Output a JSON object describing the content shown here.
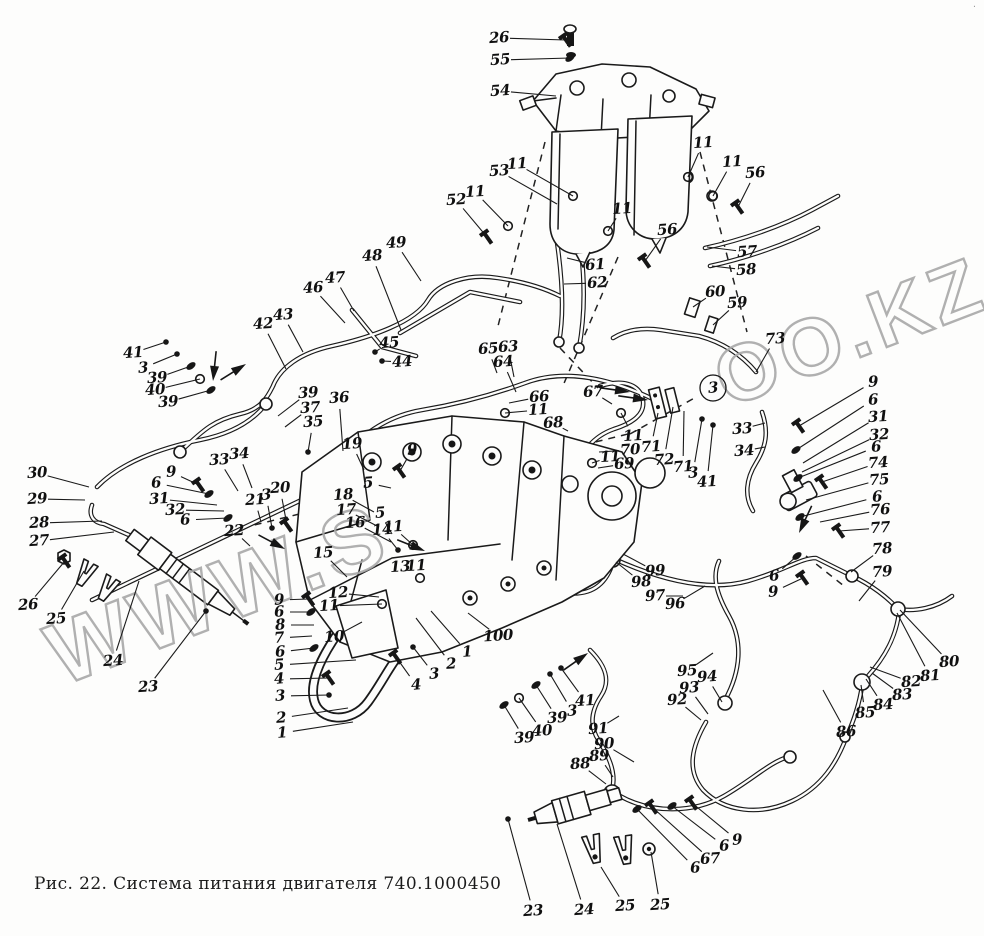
{
  "figure": {
    "caption": "Рис. 22. Система питания двигателя 740.1000450",
    "corner_mark": "·"
  },
  "watermark": {
    "seg1": "WWW.S",
    "seg2": "OO.KZ"
  },
  "callouts": [
    {
      "n": "26",
      "x": 499,
      "y": 38,
      "ex": 566,
      "ey": 40,
      "p": 2
    },
    {
      "n": "55",
      "x": 500,
      "y": 60,
      "ex": 570,
      "ey": 58,
      "p": 1
    },
    {
      "n": "54",
      "x": 500,
      "y": 91,
      "ex": 556,
      "ey": 96,
      "p": 0
    },
    {
      "n": "53",
      "x": 499,
      "y": 171,
      "ex": 557,
      "ey": 204,
      "p": 0
    },
    {
      "n": "11",
      "x": 517,
      "y": 164,
      "ex": 573,
      "ey": 196,
      "p": 3
    },
    {
      "n": "52",
      "x": 456,
      "y": 200,
      "ex": 487,
      "ey": 237,
      "p": 2
    },
    {
      "n": "11",
      "x": 475,
      "y": 192,
      "ex": 508,
      "ey": 226,
      "p": 3
    },
    {
      "n": "49",
      "x": 396,
      "y": 243,
      "ex": 421,
      "ey": 281,
      "p": 0
    },
    {
      "n": "48",
      "x": 372,
      "y": 256,
      "ex": 401,
      "ey": 330,
      "p": 0
    },
    {
      "n": "47",
      "x": 335,
      "y": 278,
      "ex": 354,
      "ey": 311,
      "p": 0
    },
    {
      "n": "46",
      "x": 313,
      "y": 288,
      "ex": 345,
      "ey": 323,
      "p": 0
    },
    {
      "n": "45",
      "x": 389,
      "y": 343,
      "ex": 375,
      "ey": 352,
      "p": 4
    },
    {
      "n": "44",
      "x": 402,
      "y": 362,
      "ex": 382,
      "ey": 361,
      "p": 4
    },
    {
      "n": "43",
      "x": 283,
      "y": 315,
      "ex": 303,
      "ey": 352,
      "p": 0
    },
    {
      "n": "42",
      "x": 263,
      "y": 324,
      "ex": 286,
      "ey": 369,
      "p": 0
    },
    {
      "n": "41",
      "x": 133,
      "y": 353,
      "ex": 166,
      "ey": 342,
      "p": 4
    },
    {
      "n": "3",
      "x": 143,
      "y": 368,
      "ex": 177,
      "ey": 354,
      "p": 4
    },
    {
      "n": "39",
      "x": 157,
      "y": 378,
      "ex": 191,
      "ey": 366,
      "p": 1
    },
    {
      "n": "40",
      "x": 155,
      "y": 390,
      "ex": 200,
      "ey": 379,
      "p": 3
    },
    {
      "n": "39",
      "x": 168,
      "y": 402,
      "ex": 211,
      "ey": 390,
      "p": 1
    },
    {
      "n": "39",
      "x": 308,
      "y": 393,
      "ex": 278,
      "ey": 416,
      "p": 0
    },
    {
      "n": "37",
      "x": 310,
      "y": 408,
      "ex": 285,
      "ey": 427,
      "p": 0
    },
    {
      "n": "35",
      "x": 313,
      "y": 422,
      "ex": 308,
      "ey": 452,
      "p": 4
    },
    {
      "n": "36",
      "x": 339,
      "y": 398,
      "ex": 343,
      "ey": 451,
      "p": 0
    },
    {
      "n": "19",
      "x": 352,
      "y": 444,
      "ex": 364,
      "ey": 470,
      "p": 0
    },
    {
      "n": "9",
      "x": 412,
      "y": 450,
      "ex": 400,
      "ey": 471,
      "p": 2
    },
    {
      "n": "61",
      "x": 595,
      "y": 265,
      "ex": 567,
      "ey": 258,
      "p": 0
    },
    {
      "n": "62",
      "x": 597,
      "y": 283,
      "ex": 564,
      "ey": 284,
      "p": 0
    },
    {
      "n": "11",
      "x": 622,
      "y": 209,
      "ex": 608,
      "ey": 231,
      "p": 3
    },
    {
      "n": "56",
      "x": 667,
      "y": 230,
      "ex": 645,
      "ey": 261,
      "p": 2
    },
    {
      "n": "11",
      "x": 703,
      "y": 143,
      "ex": 688,
      "ey": 177,
      "p": 3
    },
    {
      "n": "11",
      "x": 732,
      "y": 162,
      "ex": 713,
      "ey": 196,
      "p": 3
    },
    {
      "n": "56",
      "x": 755,
      "y": 173,
      "ex": 738,
      "ey": 207,
      "p": 2
    },
    {
      "n": "57",
      "x": 747,
      "y": 252,
      "ex": 707,
      "ey": 247,
      "p": 0
    },
    {
      "n": "58",
      "x": 746,
      "y": 270,
      "ex": 712,
      "ey": 266,
      "p": 0
    },
    {
      "n": "60",
      "x": 715,
      "y": 292,
      "ex": 693,
      "ey": 307,
      "p": 0
    },
    {
      "n": "59",
      "x": 737,
      "y": 303,
      "ex": 713,
      "ey": 325,
      "p": 0
    },
    {
      "n": "73",
      "x": 775,
      "y": 339,
      "ex": 756,
      "ey": 372,
      "p": 0
    },
    {
      "n": "65",
      "x": 488,
      "y": 349,
      "ex": 497,
      "ey": 373,
      "p": 0
    },
    {
      "n": "63",
      "x": 508,
      "y": 347,
      "ex": 514,
      "ey": 377,
      "p": 0
    },
    {
      "n": "64",
      "x": 503,
      "y": 362,
      "ex": 516,
      "ey": 392,
      "p": 0
    },
    {
      "n": "66",
      "x": 539,
      "y": 397,
      "ex": 509,
      "ey": 403,
      "p": 0
    },
    {
      "n": "11",
      "x": 538,
      "y": 410,
      "ex": 505,
      "ey": 413,
      "p": 3
    },
    {
      "n": "68",
      "x": 553,
      "y": 423,
      "ex": 568,
      "ey": 431,
      "p": 0
    },
    {
      "n": "67",
      "x": 593,
      "y": 392,
      "ex": 612,
      "ey": 404,
      "p": 0
    },
    {
      "n": "11",
      "x": 633,
      "y": 436,
      "ex": 621,
      "ey": 413,
      "p": 3
    },
    {
      "n": "70",
      "x": 630,
      "y": 450,
      "ex": 599,
      "ey": 452,
      "p": 0
    },
    {
      "n": "11",
      "x": 610,
      "y": 457,
      "ex": 592,
      "ey": 463,
      "p": 3
    },
    {
      "n": "69",
      "x": 624,
      "y": 464,
      "ex": 598,
      "ey": 468,
      "p": 0
    },
    {
      "n": "71",
      "x": 651,
      "y": 447,
      "ex": 658,
      "ey": 413,
      "p": 0
    },
    {
      "n": "72",
      "x": 664,
      "y": 460,
      "ex": 673,
      "ey": 407,
      "p": 0
    },
    {
      "n": "71",
      "x": 683,
      "y": 467,
      "ex": 684,
      "ey": 411,
      "p": 0
    },
    {
      "n": "3",
      "x": 693,
      "y": 473,
      "ex": 702,
      "ey": 419,
      "p": 4
    },
    {
      "n": "41",
      "x": 707,
      "y": 482,
      "ex": 713,
      "ey": 425,
      "p": 4
    },
    {
      "n": "3",
      "x": 713,
      "y": 388,
      "ex": 713,
      "ey": 388,
      "p": 5
    },
    {
      "n": "33",
      "x": 742,
      "y": 429,
      "ex": 765,
      "ey": 423,
      "p": 0
    },
    {
      "n": "34",
      "x": 744,
      "y": 451,
      "ex": 765,
      "ey": 447,
      "p": 0
    },
    {
      "n": "9",
      "x": 873,
      "y": 382,
      "ex": 799,
      "ey": 426,
      "p": 2
    },
    {
      "n": "6",
      "x": 873,
      "y": 400,
      "ex": 796,
      "ey": 450,
      "p": 1
    },
    {
      "n": "31",
      "x": 878,
      "y": 417,
      "ex": 803,
      "ey": 463,
      "p": 0
    },
    {
      "n": "32",
      "x": 879,
      "y": 435,
      "ex": 802,
      "ey": 472,
      "p": 0
    },
    {
      "n": "6",
      "x": 876,
      "y": 447,
      "ex": 798,
      "ey": 478,
      "p": 1
    },
    {
      "n": "74",
      "x": 878,
      "y": 463,
      "ex": 822,
      "ey": 482,
      "p": 2
    },
    {
      "n": "75",
      "x": 879,
      "y": 480,
      "ex": 806,
      "ey": 500,
      "p": 0
    },
    {
      "n": "6",
      "x": 877,
      "y": 497,
      "ex": 800,
      "ey": 517,
      "p": 1
    },
    {
      "n": "76",
      "x": 880,
      "y": 510,
      "ex": 820,
      "ey": 522,
      "p": 0
    },
    {
      "n": "77",
      "x": 880,
      "y": 528,
      "ex": 839,
      "ey": 531,
      "p": 2
    },
    {
      "n": "78",
      "x": 882,
      "y": 549,
      "ex": 851,
      "ey": 572,
      "p": 0
    },
    {
      "n": "79",
      "x": 882,
      "y": 572,
      "ex": 859,
      "ey": 601,
      "p": 0
    },
    {
      "n": "6",
      "x": 774,
      "y": 576,
      "ex": 797,
      "ey": 556,
      "p": 1
    },
    {
      "n": "9",
      "x": 773,
      "y": 592,
      "ex": 803,
      "ey": 578,
      "p": 2
    },
    {
      "n": "80",
      "x": 949,
      "y": 662,
      "ex": 900,
      "ey": 610,
      "p": 0
    },
    {
      "n": "81",
      "x": 930,
      "y": 676,
      "ex": 897,
      "ey": 613,
      "p": 0
    },
    {
      "n": "82",
      "x": 911,
      "y": 682,
      "ex": 870,
      "ey": 667,
      "p": 0
    },
    {
      "n": "83",
      "x": 902,
      "y": 695,
      "ex": 872,
      "ey": 673,
      "p": 0
    },
    {
      "n": "84",
      "x": 883,
      "y": 705,
      "ex": 866,
      "ey": 679,
      "p": 0
    },
    {
      "n": "85",
      "x": 865,
      "y": 713,
      "ex": 861,
      "ey": 685,
      "p": 0
    },
    {
      "n": "86",
      "x": 846,
      "y": 732,
      "ex": 823,
      "ey": 690,
      "p": 0
    },
    {
      "n": "99",
      "x": 655,
      "y": 571,
      "ex": 623,
      "ey": 554,
      "p": 0
    },
    {
      "n": "98",
      "x": 641,
      "y": 582,
      "ex": 616,
      "ey": 562,
      "p": 0
    },
    {
      "n": "97",
      "x": 655,
      "y": 596,
      "ex": 683,
      "ey": 596,
      "p": 0
    },
    {
      "n": "96",
      "x": 675,
      "y": 604,
      "ex": 705,
      "ey": 586,
      "p": 0
    },
    {
      "n": "95",
      "x": 687,
      "y": 671,
      "ex": 713,
      "ey": 653,
      "p": 0
    },
    {
      "n": "94",
      "x": 707,
      "y": 677,
      "ex": 722,
      "ey": 702,
      "p": 0
    },
    {
      "n": "93",
      "x": 689,
      "y": 688,
      "ex": 708,
      "ey": 714,
      "p": 0
    },
    {
      "n": "92",
      "x": 677,
      "y": 700,
      "ex": 701,
      "ey": 720,
      "p": 0
    },
    {
      "n": "91",
      "x": 598,
      "y": 729,
      "ex": 619,
      "ey": 716,
      "p": 0
    },
    {
      "n": "90",
      "x": 604,
      "y": 744,
      "ex": 634,
      "ey": 762,
      "p": 0
    },
    {
      "n": "89",
      "x": 599,
      "y": 756,
      "ex": 613,
      "ey": 777,
      "p": 0
    },
    {
      "n": "88",
      "x": 580,
      "y": 764,
      "ex": 606,
      "ey": 784,
      "p": 0
    },
    {
      "n": "41",
      "x": 585,
      "y": 701,
      "ex": 561,
      "ey": 668,
      "p": 4
    },
    {
      "n": "3",
      "x": 572,
      "y": 711,
      "ex": 550,
      "ey": 674,
      "p": 4
    },
    {
      "n": "39",
      "x": 557,
      "y": 718,
      "ex": 536,
      "ey": 685,
      "p": 1
    },
    {
      "n": "40",
      "x": 542,
      "y": 731,
      "ex": 519,
      "ey": 698,
      "p": 3
    },
    {
      "n": "39",
      "x": 524,
      "y": 738,
      "ex": 504,
      "ey": 705,
      "p": 1
    },
    {
      "n": "100",
      "x": 498,
      "y": 636,
      "ex": 468,
      "ey": 613,
      "p": 0
    },
    {
      "n": "23",
      "x": 533,
      "y": 911,
      "ex": 508,
      "ey": 819,
      "p": 4
    },
    {
      "n": "24",
      "x": 584,
      "y": 910,
      "ex": 557,
      "ey": 824,
      "p": 0
    },
    {
      "n": "25",
      "x": 625,
      "y": 906,
      "ex": 601,
      "ey": 867,
      "p": 0
    },
    {
      "n": "25",
      "x": 660,
      "y": 905,
      "ex": 651,
      "ey": 852,
      "p": 0
    },
    {
      "n": "6",
      "x": 695,
      "y": 868,
      "ex": 637,
      "ey": 809,
      "p": 1
    },
    {
      "n": "67",
      "x": 710,
      "y": 859,
      "ex": 652,
      "ey": 807,
      "p": 2
    },
    {
      "n": "6",
      "x": 724,
      "y": 846,
      "ex": 672,
      "ey": 806,
      "p": 1
    },
    {
      "n": "9",
      "x": 737,
      "y": 840,
      "ex": 692,
      "ey": 803,
      "p": 2
    },
    {
      "n": "30",
      "x": 37,
      "y": 473,
      "ex": 89,
      "ey": 487,
      "p": 0
    },
    {
      "n": "29",
      "x": 37,
      "y": 499,
      "ex": 85,
      "ey": 500,
      "p": 0
    },
    {
      "n": "28",
      "x": 39,
      "y": 523,
      "ex": 102,
      "ey": 521,
      "p": 0
    },
    {
      "n": "27",
      "x": 39,
      "y": 541,
      "ex": 114,
      "ey": 532,
      "p": 0
    },
    {
      "n": "26",
      "x": 28,
      "y": 605,
      "ex": 65,
      "ey": 561,
      "p": 2
    },
    {
      "n": "25",
      "x": 56,
      "y": 619,
      "ex": 84,
      "ey": 571,
      "p": 0
    },
    {
      "n": "24",
      "x": 113,
      "y": 661,
      "ex": 139,
      "ey": 581,
      "p": 0
    },
    {
      "n": "23",
      "x": 148,
      "y": 687,
      "ex": 206,
      "ey": 611,
      "p": 4
    },
    {
      "n": "9",
      "x": 171,
      "y": 472,
      "ex": 199,
      "ey": 485,
      "p": 2
    },
    {
      "n": "6",
      "x": 156,
      "y": 483,
      "ex": 209,
      "ey": 494,
      "p": 1
    },
    {
      "n": "31",
      "x": 159,
      "y": 499,
      "ex": 217,
      "ey": 505,
      "p": 0
    },
    {
      "n": "32",
      "x": 175,
      "y": 510,
      "ex": 224,
      "ey": 511,
      "p": 0
    },
    {
      "n": "6",
      "x": 185,
      "y": 520,
      "ex": 228,
      "ey": 518,
      "p": 1
    },
    {
      "n": "33",
      "x": 219,
      "y": 460,
      "ex": 238,
      "ey": 491,
      "p": 0
    },
    {
      "n": "34",
      "x": 239,
      "y": 454,
      "ex": 252,
      "ey": 488,
      "p": 0
    },
    {
      "n": "21",
      "x": 255,
      "y": 500,
      "ex": 261,
      "ey": 522,
      "p": 0
    },
    {
      "n": "3",
      "x": 266,
      "y": 495,
      "ex": 272,
      "ey": 528,
      "p": 4
    },
    {
      "n": "20",
      "x": 280,
      "y": 488,
      "ex": 287,
      "ey": 525,
      "p": 2
    },
    {
      "n": "22",
      "x": 234,
      "y": 531,
      "ex": 250,
      "ey": 546,
      "p": 0
    },
    {
      "n": "9",
      "x": 279,
      "y": 600,
      "ex": 309,
      "ey": 599,
      "p": 2
    },
    {
      "n": "6",
      "x": 279,
      "y": 612,
      "ex": 311,
      "ey": 612,
      "p": 1
    },
    {
      "n": "8",
      "x": 280,
      "y": 625,
      "ex": 314,
      "ey": 625,
      "p": 0
    },
    {
      "n": "7",
      "x": 279,
      "y": 638,
      "ex": 312,
      "ey": 636,
      "p": 0
    },
    {
      "n": "6",
      "x": 280,
      "y": 652,
      "ex": 314,
      "ey": 648,
      "p": 1
    },
    {
      "n": "5",
      "x": 279,
      "y": 665,
      "ex": 356,
      "ey": 660,
      "p": 0
    },
    {
      "n": "4",
      "x": 279,
      "y": 679,
      "ex": 329,
      "ey": 678,
      "p": 2
    },
    {
      "n": "3",
      "x": 280,
      "y": 696,
      "ex": 329,
      "ey": 695,
      "p": 4
    },
    {
      "n": "2",
      "x": 281,
      "y": 718,
      "ex": 348,
      "ey": 708,
      "p": 0
    },
    {
      "n": "1",
      "x": 282,
      "y": 733,
      "ex": 353,
      "ey": 722,
      "p": 0
    },
    {
      "n": "15",
      "x": 323,
      "y": 553,
      "ex": 347,
      "ey": 577,
      "p": 0
    },
    {
      "n": "12",
      "x": 338,
      "y": 593,
      "ex": 379,
      "ey": 597,
      "p": 0
    },
    {
      "n": "11",
      "x": 329,
      "y": 606,
      "ex": 382,
      "ey": 604,
      "p": 3
    },
    {
      "n": "10",
      "x": 334,
      "y": 637,
      "ex": 362,
      "ey": 622,
      "p": 0
    },
    {
      "n": "13",
      "x": 400,
      "y": 567,
      "ex": 403,
      "ey": 578,
      "p": 0
    },
    {
      "n": "11",
      "x": 416,
      "y": 566,
      "ex": 420,
      "ey": 578,
      "p": 3
    },
    {
      "n": "1",
      "x": 467,
      "y": 652,
      "ex": 431,
      "ey": 611,
      "p": 0
    },
    {
      "n": "2",
      "x": 451,
      "y": 664,
      "ex": 416,
      "ey": 618,
      "p": 0
    },
    {
      "n": "3",
      "x": 434,
      "y": 674,
      "ex": 413,
      "ey": 647,
      "p": 4
    },
    {
      "n": "4",
      "x": 416,
      "y": 685,
      "ex": 396,
      "ey": 657,
      "p": 2
    },
    {
      "n": "5",
      "x": 368,
      "y": 483,
      "ex": 391,
      "ey": 488,
      "p": 0
    },
    {
      "n": "18",
      "x": 343,
      "y": 495,
      "ex": 374,
      "ey": 512,
      "p": 0
    },
    {
      "n": "17",
      "x": 346,
      "y": 510,
      "ex": 379,
      "ey": 527,
      "p": 0
    },
    {
      "n": "16",
      "x": 355,
      "y": 523,
      "ex": 391,
      "ey": 542,
      "p": 0
    },
    {
      "n": "5",
      "x": 380,
      "y": 513,
      "ex": 392,
      "ey": 534,
      "p": 0
    },
    {
      "n": "14",
      "x": 382,
      "y": 530,
      "ex": 398,
      "ey": 550,
      "p": 4
    },
    {
      "n": "11",
      "x": 393,
      "y": 527,
      "ex": 413,
      "ey": 545,
      "p": 3
    }
  ]
}
